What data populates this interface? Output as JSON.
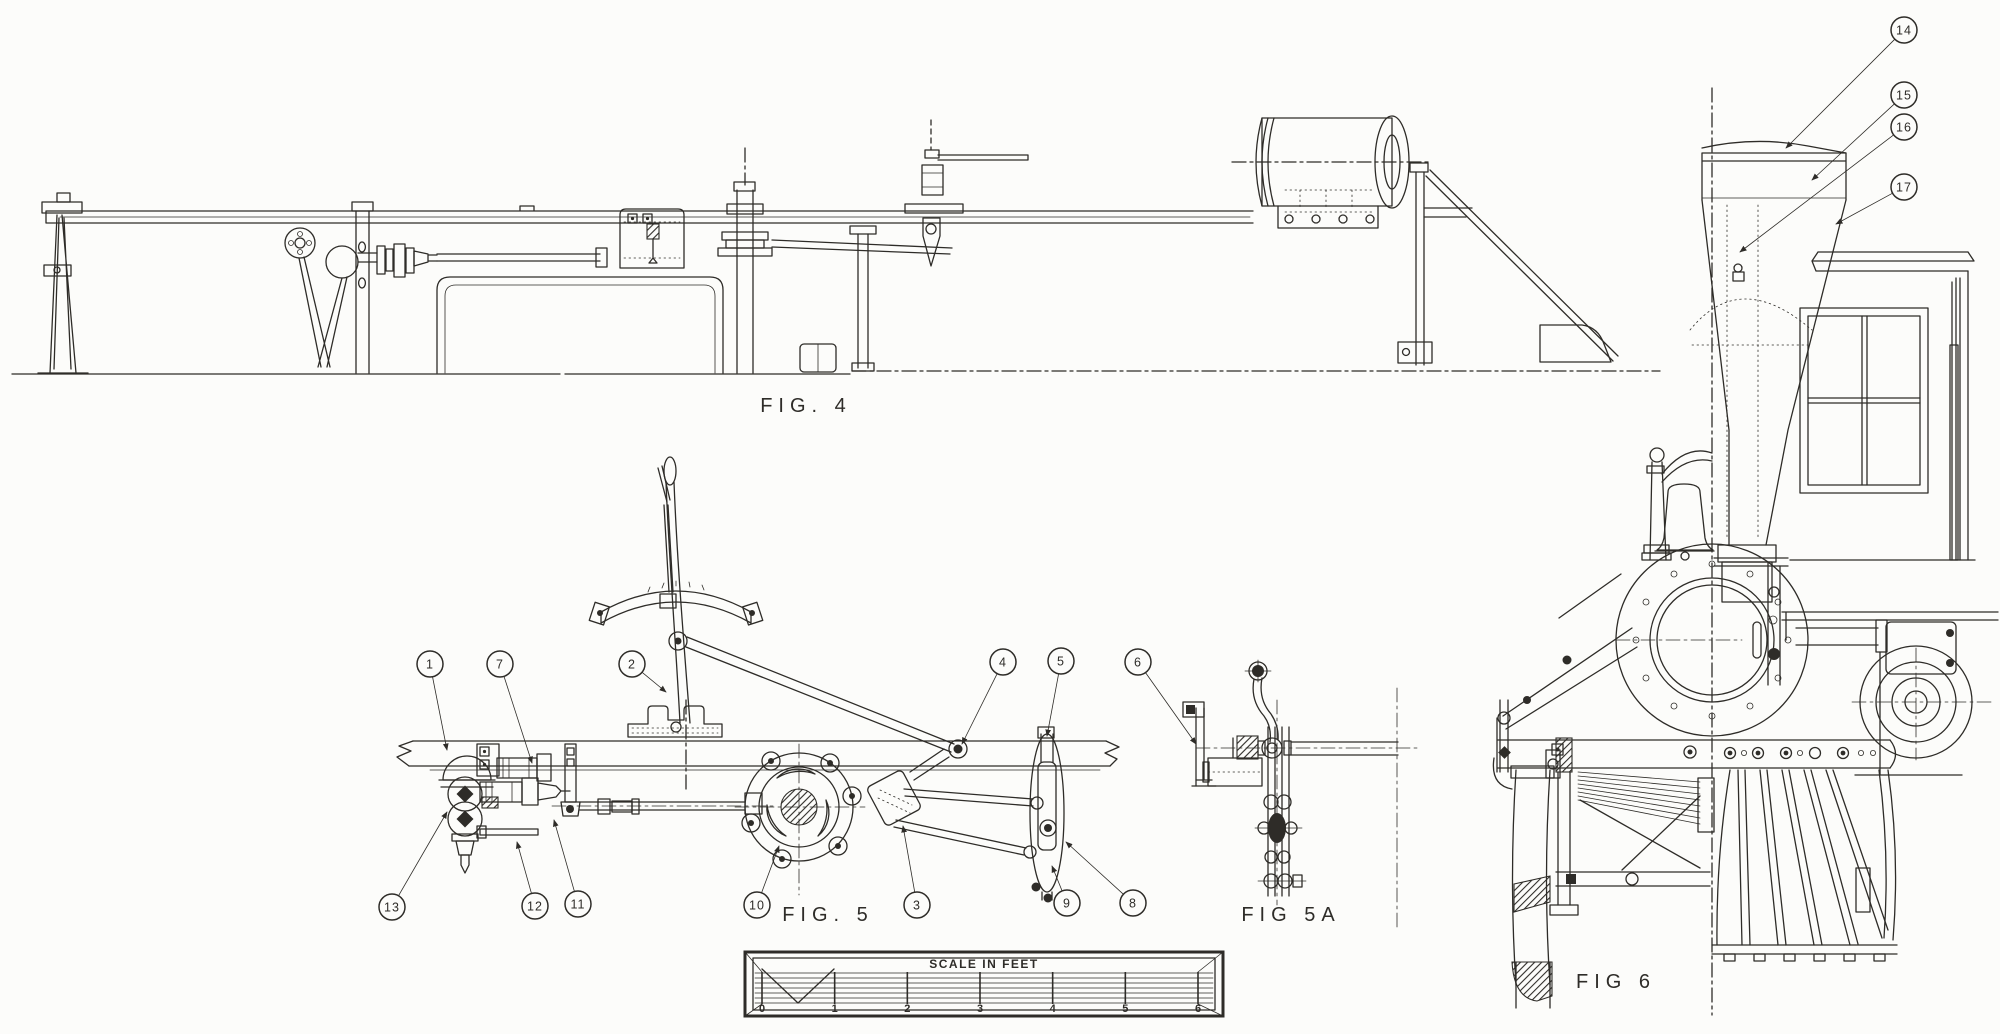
{
  "drawing": {
    "kind": "locomotive valve-gear engineering line drawing",
    "paper_color": "#fcfcfa",
    "ink_color": "#2e2c28"
  },
  "figure_labels": [
    {
      "id": "fig4",
      "text": "FIG. 4",
      "x": 806,
      "y": 412
    },
    {
      "id": "fig5",
      "text": "FIG. 5",
      "x": 828,
      "y": 921
    },
    {
      "id": "fig5a",
      "text": "FIG 5A",
      "x": 1291,
      "y": 921
    },
    {
      "id": "fig6",
      "text": "FIG 6",
      "x": 1616,
      "y": 988
    }
  ],
  "callouts": [
    {
      "num": "1",
      "cx": 430,
      "cy": 664,
      "tx": 447,
      "ty": 750
    },
    {
      "num": "7",
      "cx": 500,
      "cy": 664,
      "tx": 532,
      "ty": 763
    },
    {
      "num": "2",
      "cx": 632,
      "cy": 664,
      "tx": 666,
      "ty": 692
    },
    {
      "num": "4",
      "cx": 1003,
      "cy": 662,
      "tx": 962,
      "ty": 744
    },
    {
      "num": "5",
      "cx": 1061,
      "cy": 661,
      "tx": 1047,
      "ty": 736
    },
    {
      "num": "6",
      "cx": 1138,
      "cy": 662,
      "tx": 1196,
      "ty": 744
    },
    {
      "num": "13",
      "cx": 392,
      "cy": 907,
      "tx": 447,
      "ty": 812
    },
    {
      "num": "12",
      "cx": 535,
      "cy": 906,
      "tx": 517,
      "ty": 842
    },
    {
      "num": "11",
      "cx": 578,
      "cy": 904,
      "tx": 554,
      "ty": 820
    },
    {
      "num": "10",
      "cx": 757,
      "cy": 905,
      "tx": 779,
      "ty": 846
    },
    {
      "num": "3",
      "cx": 917,
      "cy": 905,
      "tx": 903,
      "ty": 826
    },
    {
      "num": "9",
      "cx": 1067,
      "cy": 903,
      "tx": 1052,
      "ty": 866
    },
    {
      "num": "8",
      "cx": 1133,
      "cy": 903,
      "tx": 1066,
      "ty": 842
    },
    {
      "num": "14",
      "cx": 1904,
      "cy": 30,
      "tx": 1786,
      "ty": 148
    },
    {
      "num": "15",
      "cx": 1904,
      "cy": 95,
      "tx": 1812,
      "ty": 180
    },
    {
      "num": "16",
      "cx": 1904,
      "cy": 127,
      "tx": 1740,
      "ty": 252
    },
    {
      "num": "17",
      "cx": 1904,
      "cy": 187,
      "tx": 1836,
      "ty": 224
    }
  ],
  "scale_bar": {
    "title": "SCALE IN FEET",
    "ticks": [
      "0",
      "1",
      "2",
      "3",
      "4",
      "5",
      "6"
    ],
    "frame": {
      "x": 745,
      "y": 952,
      "w": 478,
      "h": 64
    },
    "tick_x0": 762,
    "tick_x1": 1198,
    "tick_top": 972,
    "tick_bottom": 1004,
    "label_y": 1012,
    "title_x": 984,
    "title_y": 968
  }
}
